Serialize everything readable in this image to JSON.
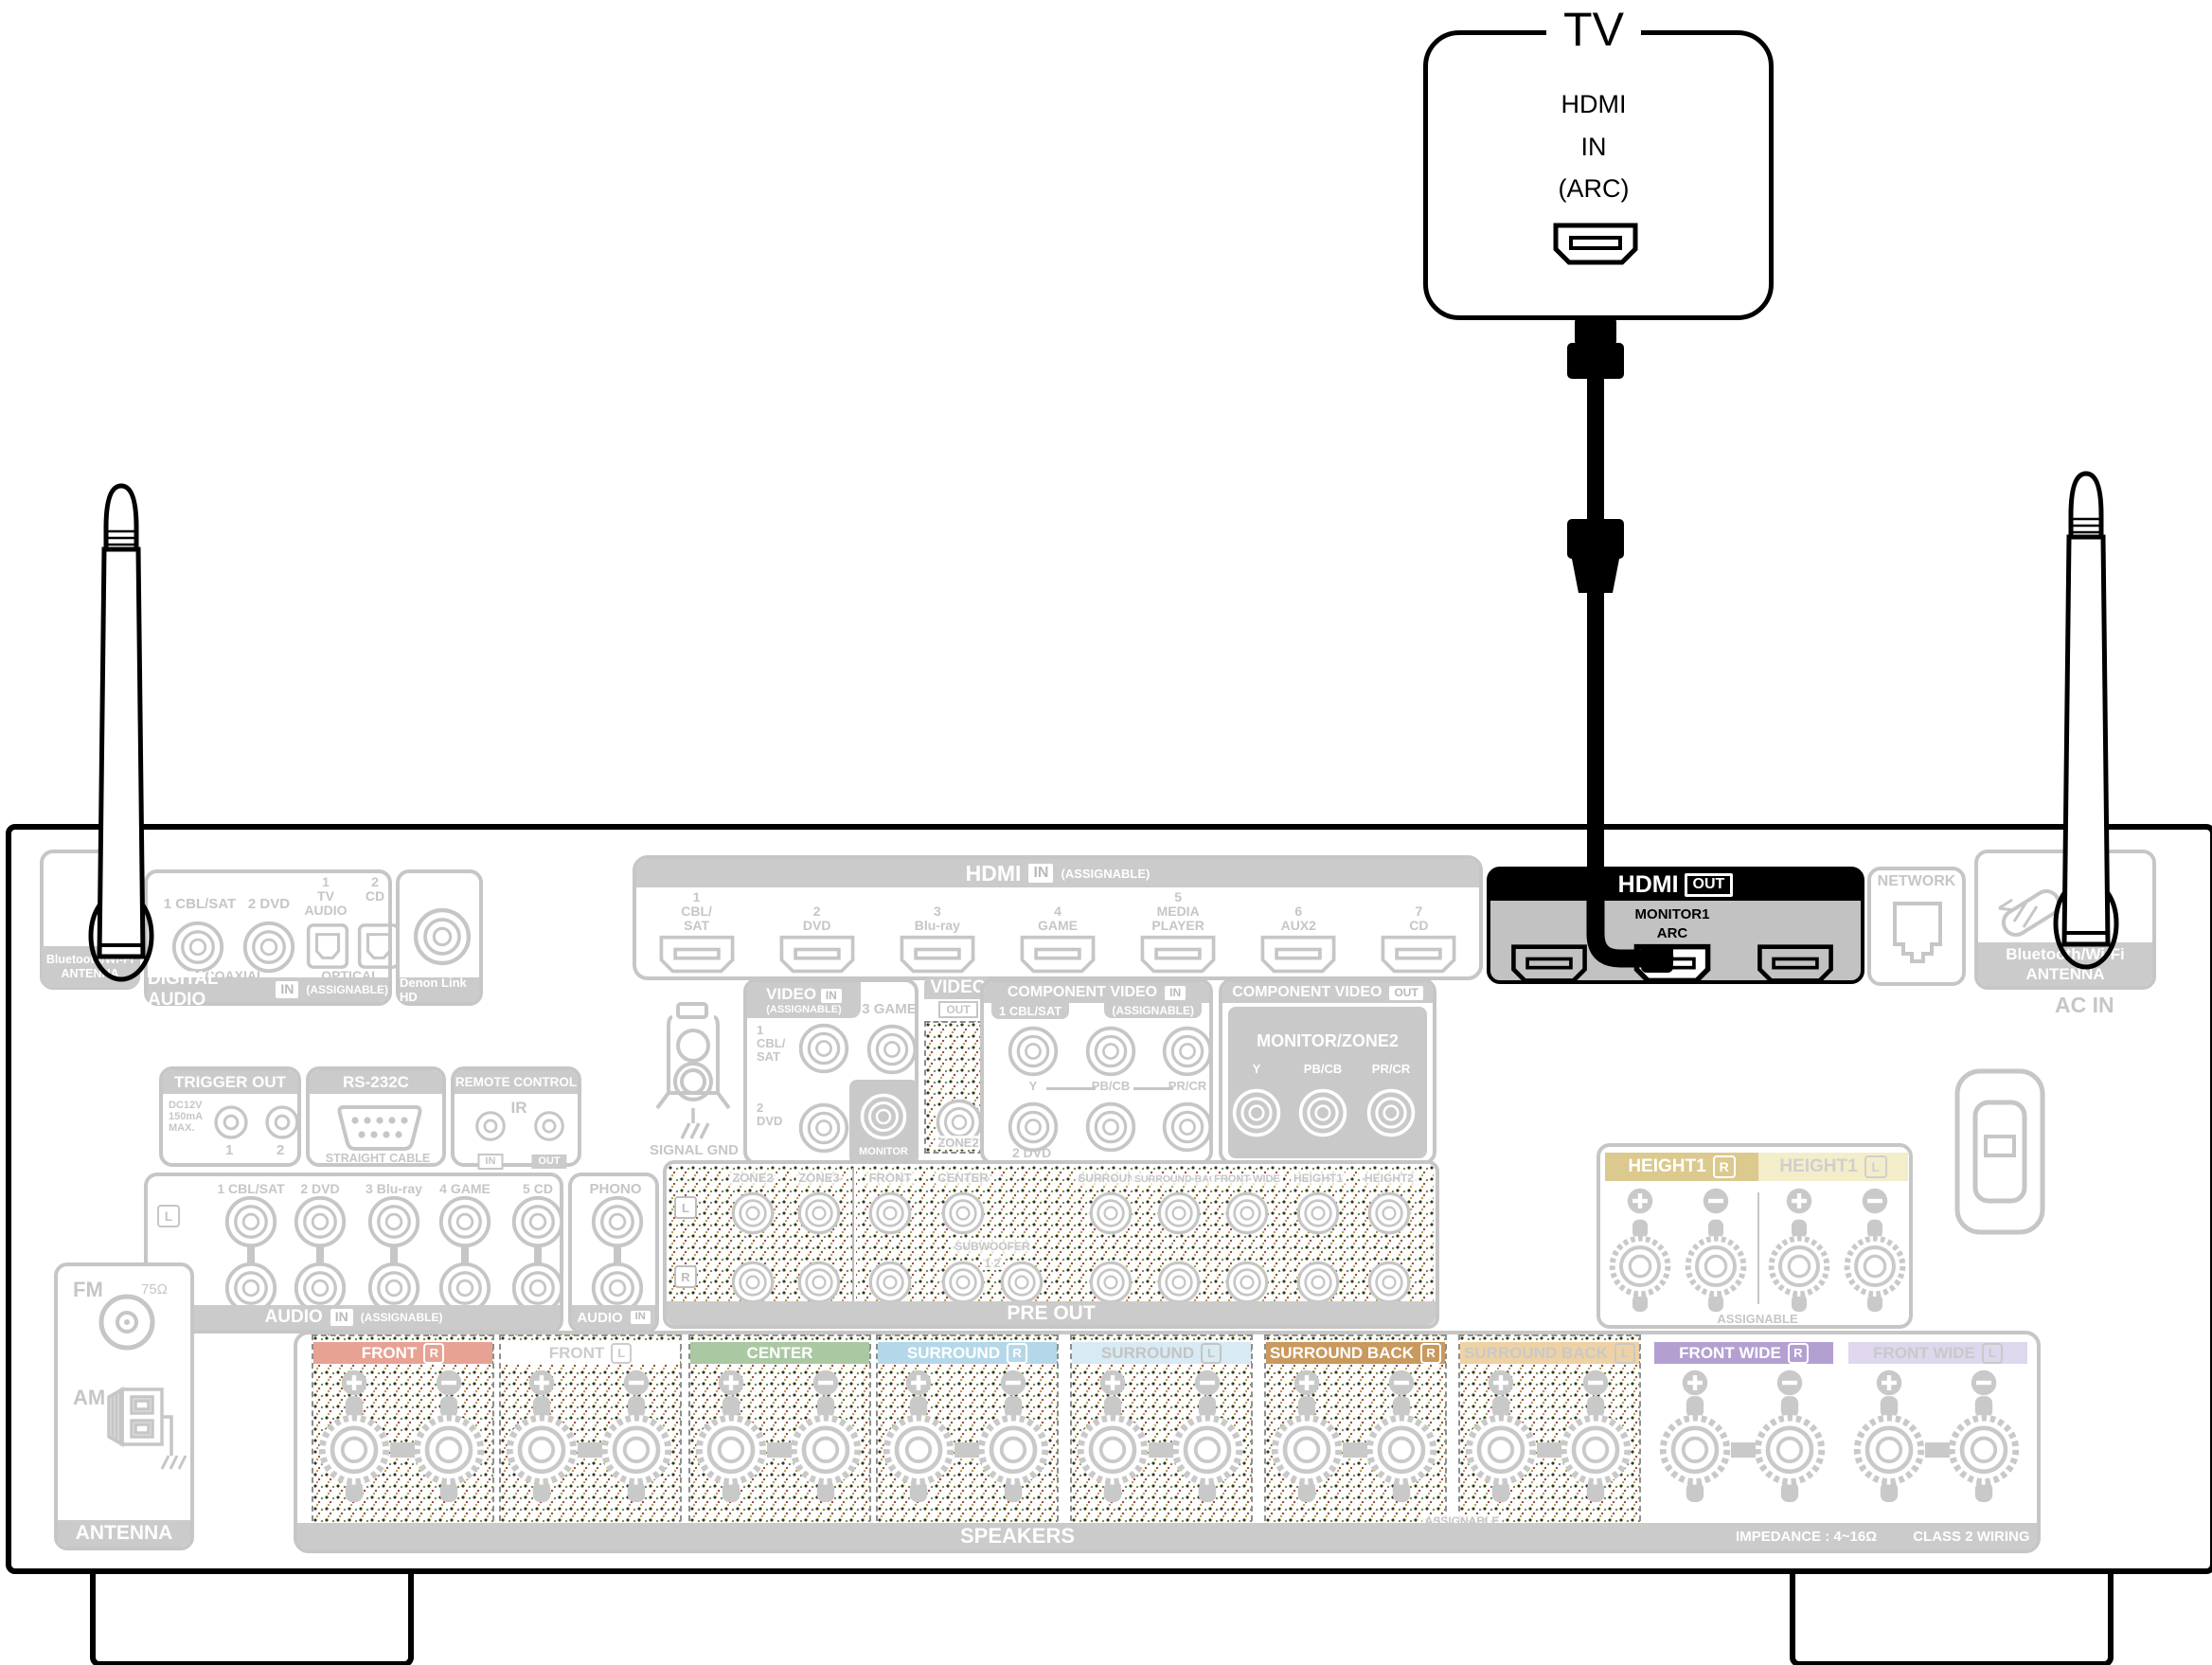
{
  "tv": {
    "title": "TV",
    "port_lines": "HDMI\nIN\n(ARC)"
  },
  "hdmi_out": {
    "title": "HDMI",
    "badge": "OUT",
    "monitor": "MONITOR1",
    "arc": "ARC"
  },
  "network": {
    "title": "NETWORK"
  },
  "bt_antenna": {
    "line1": "Bluetooth/Wi-Fi",
    "line2": "ANTENNA"
  },
  "ac_in": "AC IN",
  "digital_audio": {
    "coax": [
      "1 CBL/SAT",
      "2 DVD"
    ],
    "optical": [
      "1\nTV\nAUDIO",
      "2\nCD"
    ],
    "coaxial": "COAXIAL",
    "optical_lbl": "OPTICAL",
    "title": "DIGITAL AUDIO",
    "badge": "IN",
    "assignable": "(ASSIGNABLE)"
  },
  "denon_link": "Denon Link HD",
  "hdmi_in": {
    "title": "HDMI",
    "badge": "IN",
    "assignable": "(ASSIGNABLE)",
    "ports": [
      "1\nCBL/\nSAT",
      "2\nDVD",
      "3\nBlu-ray",
      "4\nGAME",
      "5\nMEDIA\nPLAYER",
      "6\nAUX2",
      "7\nCD"
    ]
  },
  "trigger": {
    "title": "TRIGGER OUT",
    "spec": "DC12V\n150mA\nMAX.",
    "jacks": [
      "1",
      "2"
    ]
  },
  "rs232": {
    "title": "RS-232C",
    "cable": "STRAIGHT CABLE"
  },
  "remote": {
    "title": "REMOTE CONTROL",
    "ir": "IR",
    "in_lbl": "IN",
    "out_lbl": "OUT"
  },
  "signal_gnd": "SIGNAL GND",
  "video_in": {
    "title": "VIDEO",
    "badge": "IN",
    "assignable": "(ASSIGNABLE)",
    "game": "3 GAME",
    "cbl": "1\nCBL/\nSAT",
    "dvd": "2\nDVD",
    "monitor": "MONITOR"
  },
  "video_out": {
    "title": "VIDEO",
    "badge": "OUT",
    "zone2": "ZONE2"
  },
  "component_in": {
    "title": "COMPONENT VIDEO",
    "badge": "IN",
    "assignable": "(ASSIGNABLE)",
    "cbl": "1 CBL/SAT",
    "labels": [
      "Y",
      "PB/CB",
      "PR/CR"
    ],
    "dvd": "2 DVD"
  },
  "component_out": {
    "title": "COMPONENT VIDEO",
    "badge": "OUT",
    "monitor": "MONITOR/ZONE2",
    "labels": [
      "Y",
      "PB/CB",
      "PR/CR"
    ]
  },
  "audio_in": {
    "inputs": [
      "1 CBL/SAT",
      "2 DVD",
      "3 Blu-ray",
      "4 GAME",
      "5 CD"
    ],
    "l": "L",
    "r": "R",
    "title": "AUDIO",
    "badge": "IN",
    "assignable": "(ASSIGNABLE)",
    "phono": "PHONO",
    "phono_title": "AUDIO",
    "phono_badge": "IN"
  },
  "pre_out": {
    "l": "L",
    "r": "R",
    "channels": [
      "ZONE2",
      "ZONE3",
      "FRONT",
      "CENTER",
      "SURROUND",
      "SURROUND BACK",
      "FRONT WIDE",
      "HEIGHT1",
      "HEIGHT2"
    ],
    "subwoofer": "SUBWOOFER",
    "sub_nums": "1  2",
    "title": "PRE OUT"
  },
  "height1": {
    "r_label": "HEIGHT1",
    "r_side": "R",
    "l_label": "HEIGHT1",
    "l_side": "L",
    "r_color": "#dcc98d",
    "l_color": "#f4edca",
    "assignable": "ASSIGNABLE"
  },
  "speakers": {
    "blocks": [
      {
        "label": "FRONT",
        "side": "R",
        "color": "#e7a294",
        "text": "#ffffff",
        "hatch": true
      },
      {
        "label": "FRONT",
        "side": "L",
        "color": "#ffffff",
        "text": "#cccccc",
        "hatch": true
      },
      {
        "label": "CENTER",
        "side": "",
        "color": "#aac9a3",
        "text": "#ffffff",
        "hatch": true
      },
      {
        "label": "SURROUND",
        "side": "R",
        "color": "#b4d8e9",
        "text": "#ffffff",
        "hatch": true
      },
      {
        "label": "SURROUND",
        "side": "L",
        "color": "#d8eaf3",
        "text": "#c4c4c4",
        "hatch": true
      },
      {
        "label": "SURROUND BACK",
        "side": "R",
        "color": "#c9995e",
        "text": "#ffffff",
        "hatch": true
      },
      {
        "label": "SURROUND BACK",
        "side": "L",
        "color": "#eed2a3",
        "text": "#c9c9c9",
        "hatch": true
      },
      {
        "label": "FRONT WIDE",
        "side": "R",
        "color": "#b3a0d1",
        "text": "#ffffff",
        "hatch": false
      },
      {
        "label": "FRONT WIDE",
        "side": "L",
        "color": "#ded7ed",
        "text": "#c9c9c9",
        "hatch": false
      }
    ],
    "assignable": "ASSIGNABLE",
    "title": "SPEAKERS",
    "impedance": "IMPEDANCE : 4~16Ω",
    "wiring": "CLASS 2 WIRING"
  },
  "antenna": {
    "fm": "FM",
    "ohm": "75Ω",
    "am": "AM",
    "title": "ANTENNA"
  },
  "colors": {
    "panel_gray": "#c6c6c6",
    "highlight_black": "#000000"
  }
}
